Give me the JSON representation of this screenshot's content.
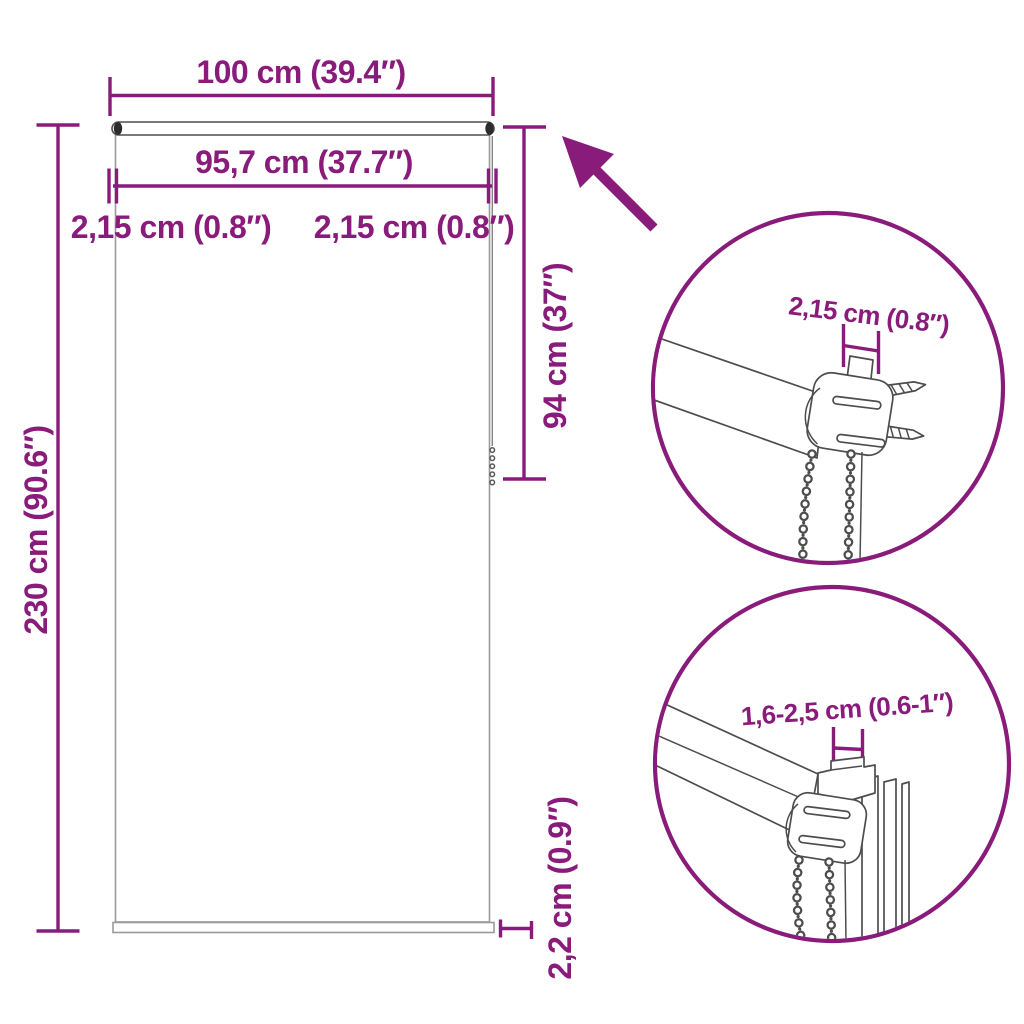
{
  "colors": {
    "accent": "#891b7b",
    "artwork_line": "#4d4d4d",
    "blind_outline": "#9a9a9a",
    "background": "#ffffff"
  },
  "dimensions": {
    "total_width": "100 cm (39.4″)",
    "fabric_width": "95,7 cm (37.7″)",
    "left_offset": "2,15 cm (0.8″)",
    "right_offset": "2,15 cm (0.8″)",
    "drop_height": "94 cm (37″)",
    "total_height": "230 cm (90.6″)",
    "bottom_bar": "2,2 cm (0.9″)"
  },
  "details": {
    "top_circle_label": "2,15 cm (0.8″)",
    "bottom_circle_label": "1,6-2,5 cm (0.6-1″)"
  }
}
